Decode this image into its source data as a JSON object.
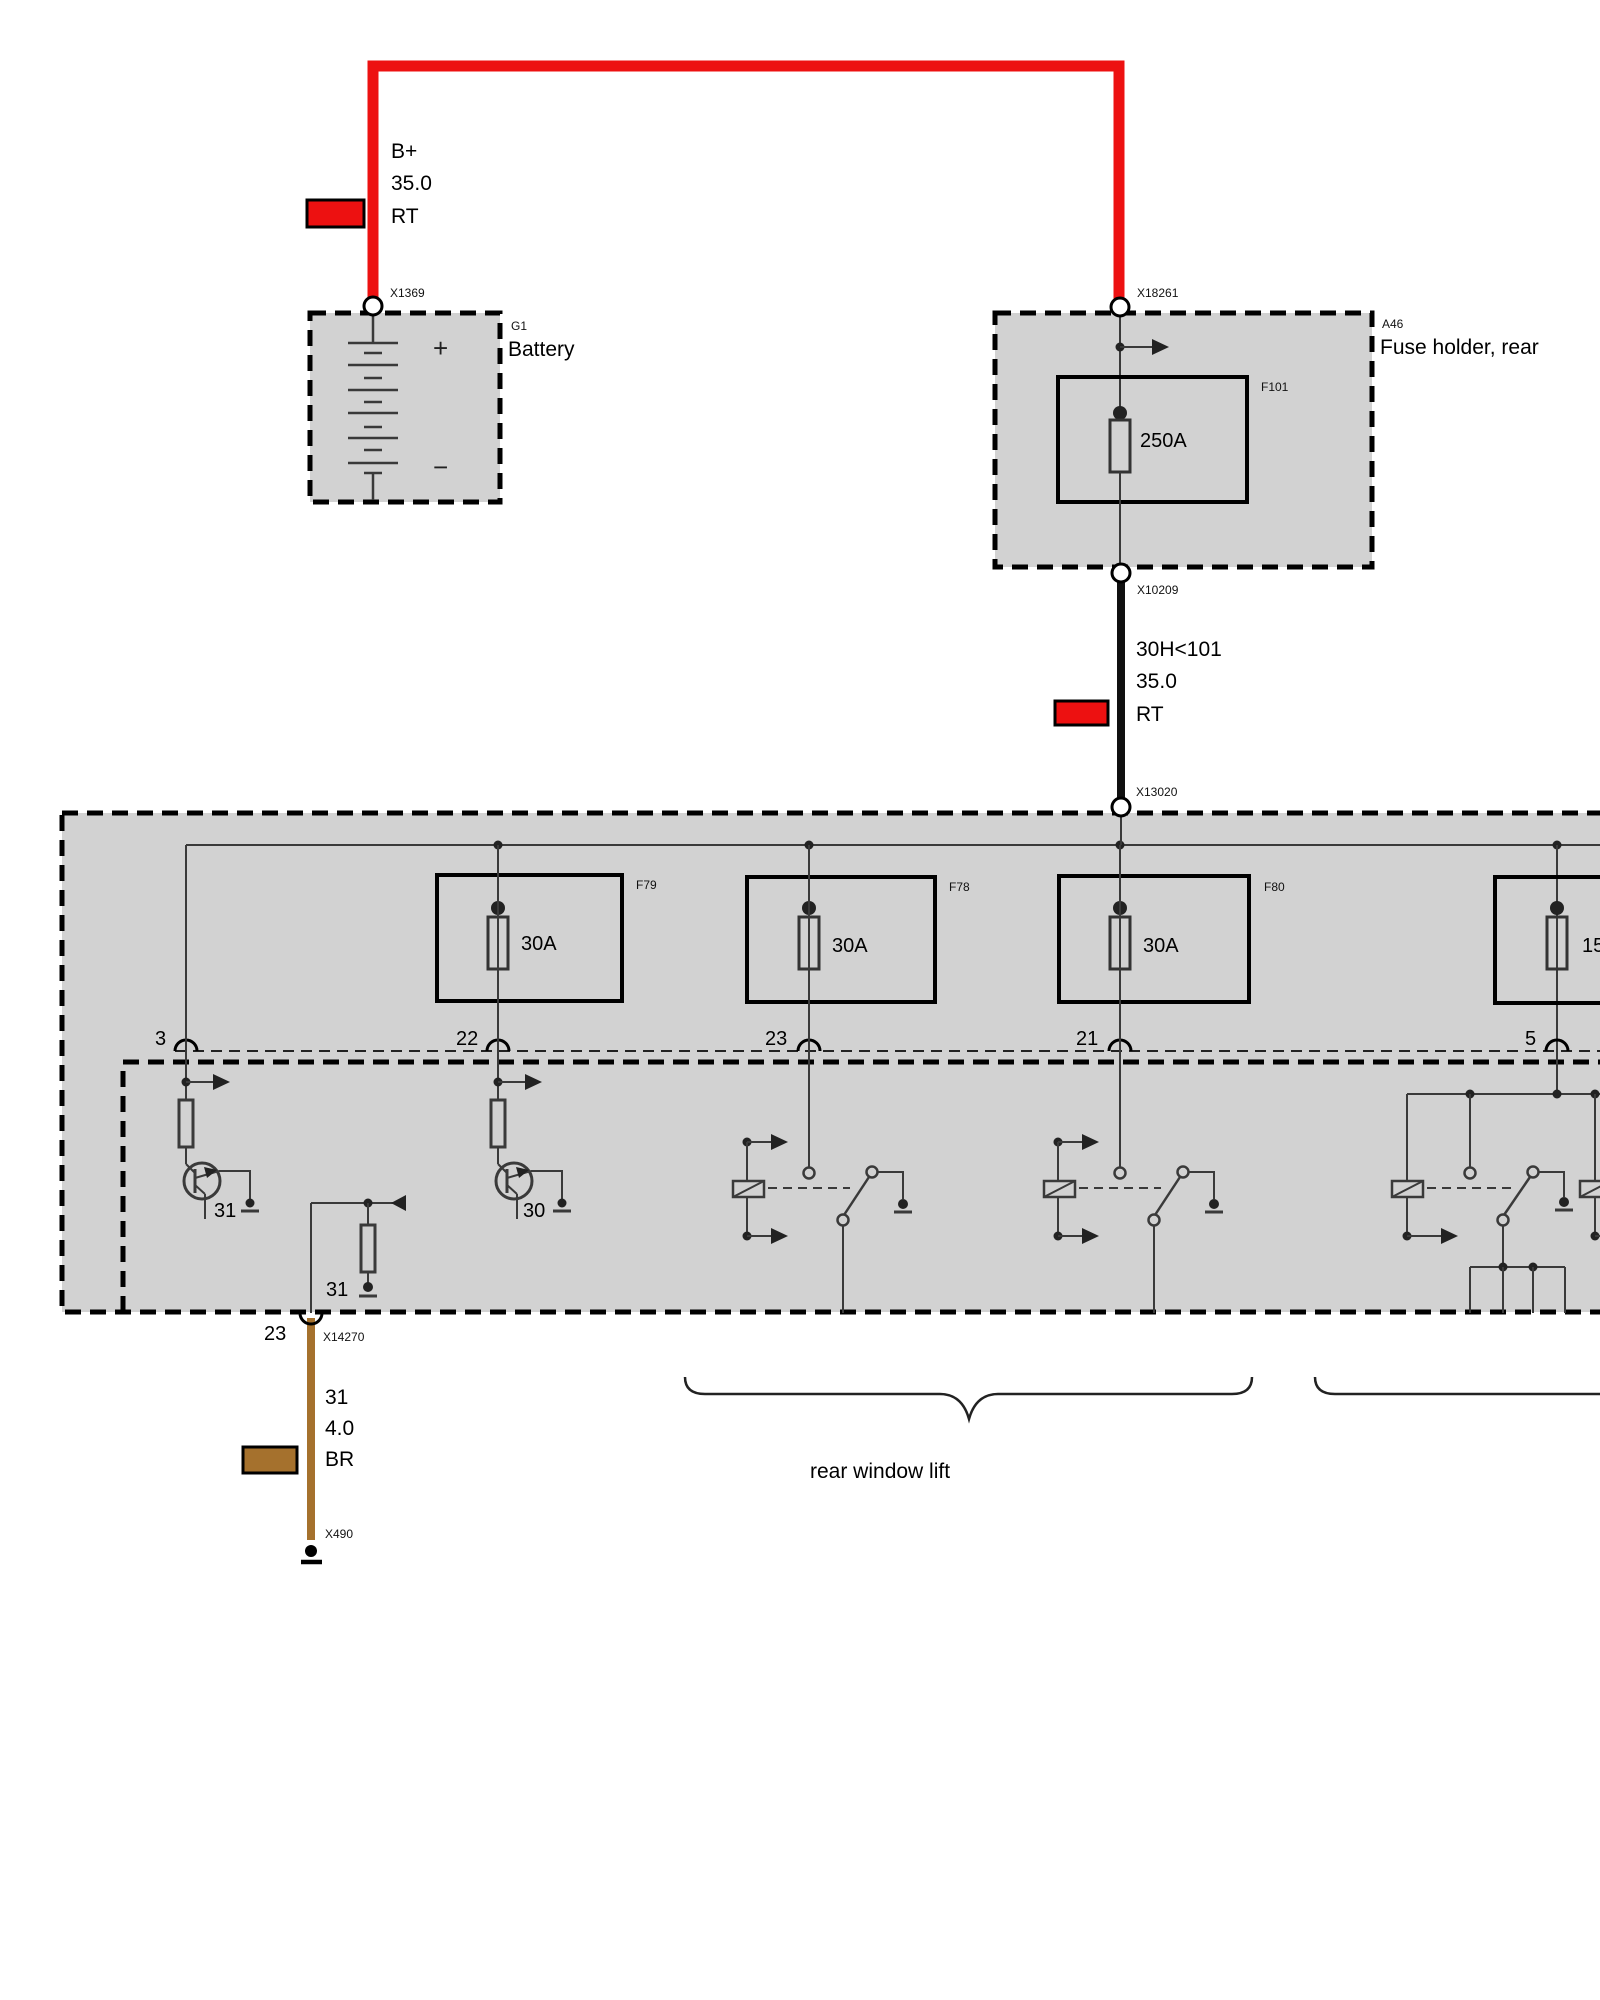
{
  "colors": {
    "wire_red": "#ED1111",
    "wire_brown": "#A5712D",
    "box_fill": "#D2D2D2",
    "line": "#3A3A3A"
  },
  "battery": {
    "ref": "G1",
    "name": "Battery",
    "plus": "+",
    "minus": "−",
    "connector_top": "X1369"
  },
  "wire_battery": {
    "circuit": "B+",
    "gauge": "35.0",
    "color_code": "RT"
  },
  "fuse_holder": {
    "ref": "A46",
    "name": "Fuse holder, rear",
    "fuse_ref": "F101",
    "fuse_rating": "250A",
    "connector_top": "X18261",
    "connector_bottom": "X10209"
  },
  "wire_main": {
    "circuit": "30H<101",
    "gauge": "35.0",
    "color_code": "RT"
  },
  "distribution_box": {
    "connector_top": "X13020",
    "fuses": [
      {
        "ref": "F79",
        "rating": "30A"
      },
      {
        "ref": "F78",
        "rating": "30A"
      },
      {
        "ref": "F80",
        "rating": "30A"
      },
      {
        "ref": "",
        "rating": "15"
      }
    ],
    "pins": {
      "p3": "3",
      "p22": "22",
      "p23": "23",
      "p21": "21",
      "p5": "5"
    },
    "internal": {
      "t1": "31",
      "t2": "30",
      "r1": "31"
    },
    "bottom_pin": {
      "number": "23",
      "connector": "X14270"
    }
  },
  "wire_ground": {
    "circuit": "31",
    "gauge": "4.0",
    "color_code": "BR",
    "connector_bottom": "X490"
  },
  "annotation": {
    "group_label": "rear window lift"
  }
}
